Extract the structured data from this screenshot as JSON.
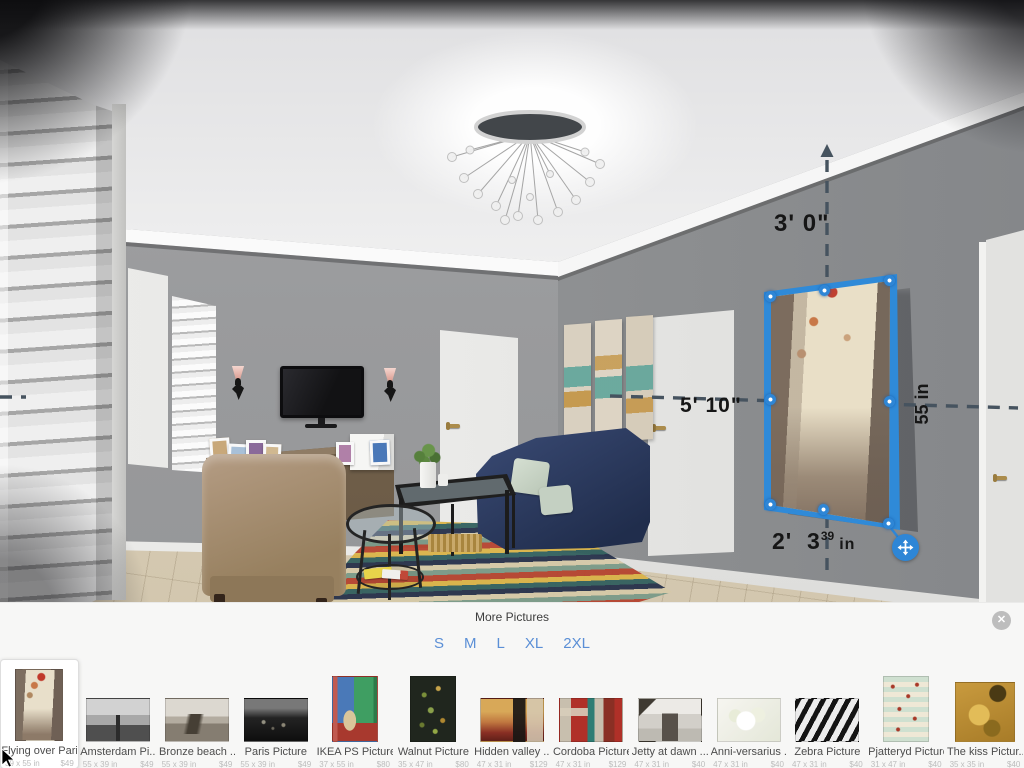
{
  "app": {
    "name": "3D Room Planner"
  },
  "colors": {
    "accent_blue": "#2e86d6",
    "size_link_blue": "#5b8fd6",
    "measurement_dash": "#46535f",
    "wall_gray": "#9a9b9d",
    "panel_background": "#f7f7f6"
  },
  "measurements": {
    "above_picture": "3' 0\"",
    "left_of_picture": "5' 10\"",
    "picture_height": "55 in",
    "below_feet": "2'",
    "below_inches": "3",
    "below_fraction": "39",
    "below_unit": "in"
  },
  "panel": {
    "title": "More Pictures",
    "sizes": [
      "S",
      "M",
      "L",
      "XL",
      "2XL"
    ],
    "close_glyph": "✕",
    "items": [
      {
        "name": "Flying over Pari...",
        "dimensions": "39 x 55 in",
        "price": "$49",
        "selected": true,
        "art": "paris-balloons"
      },
      {
        "name": "Amsterdam Pi...",
        "dimensions": "55 x 39 in",
        "price": "$49",
        "art": "amsterdam-canal-bw"
      },
      {
        "name": "Bronze beach ...",
        "dimensions": "55 x 39 in",
        "price": "$49",
        "art": "sepia-beach"
      },
      {
        "name": "Paris Picture",
        "dimensions": "55 x 39 in",
        "price": "$49",
        "art": "paris-night-bw"
      },
      {
        "name": "IKEA PS Picture",
        "dimensions": "37 x 55 in",
        "price": "$80",
        "art": "colorful-figure-poster"
      },
      {
        "name": "Walnut Picture",
        "dimensions": "35 x 47 in",
        "price": "$80",
        "art": "dark-botanical-chart"
      },
      {
        "name": "Hidden valley ...",
        "dimensions": "47 x 31 in",
        "price": "$129",
        "art": "abstract-orange-red"
      },
      {
        "name": "Cordoba Picture",
        "dimensions": "47 x 31 in",
        "price": "$129",
        "art": "abstract-collage"
      },
      {
        "name": "Jetty at dawn ...",
        "dimensions": "47 x 31 in",
        "price": "$40",
        "art": "jetty-bw"
      },
      {
        "name": "Anni-versarius ...",
        "dimensions": "47 x 31 in",
        "price": "$40",
        "art": "white-blossoms"
      },
      {
        "name": "Zebra Picture",
        "dimensions": "47 x 31 in",
        "price": "$40",
        "art": "zebra-stripes"
      },
      {
        "name": "Pjatteryd Picture",
        "dimensions": "31 x 47 in",
        "price": "$40",
        "art": "striped-birds-pattern"
      },
      {
        "name": "The kiss Pictur...",
        "dimensions": "35 x 35 in",
        "price": "$40",
        "art": "klimt-kiss-gold"
      }
    ]
  }
}
